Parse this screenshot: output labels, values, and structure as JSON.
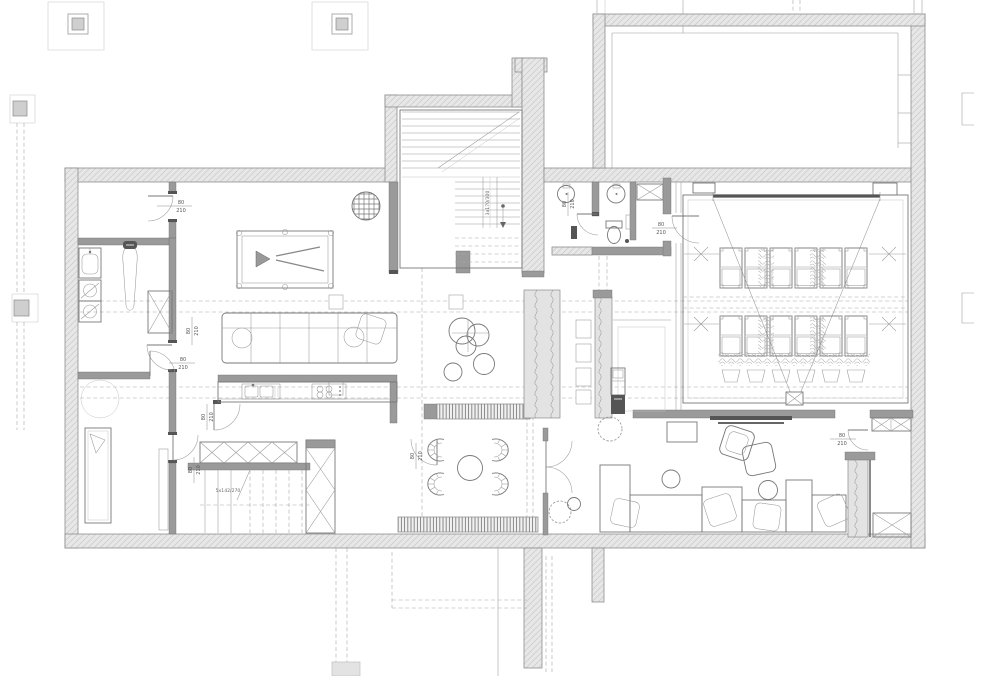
{
  "plan": {
    "door_label": {
      "width": "80",
      "height": "210"
    },
    "stair_note_main": "3x170/300",
    "stair_note_lower": "5x142/270",
    "colors": {
      "paper": "#ffffff",
      "wall_fill": "#e7e7e7",
      "wall_hatch": "#c9c9c9",
      "wall_edge": "#8e8e8e",
      "partition": "#9a9a9a",
      "furniture_line": "#777777",
      "thin_line": "#999999",
      "dark_fixture": "#555555",
      "dashed_grid": "#a8a8a8"
    }
  }
}
